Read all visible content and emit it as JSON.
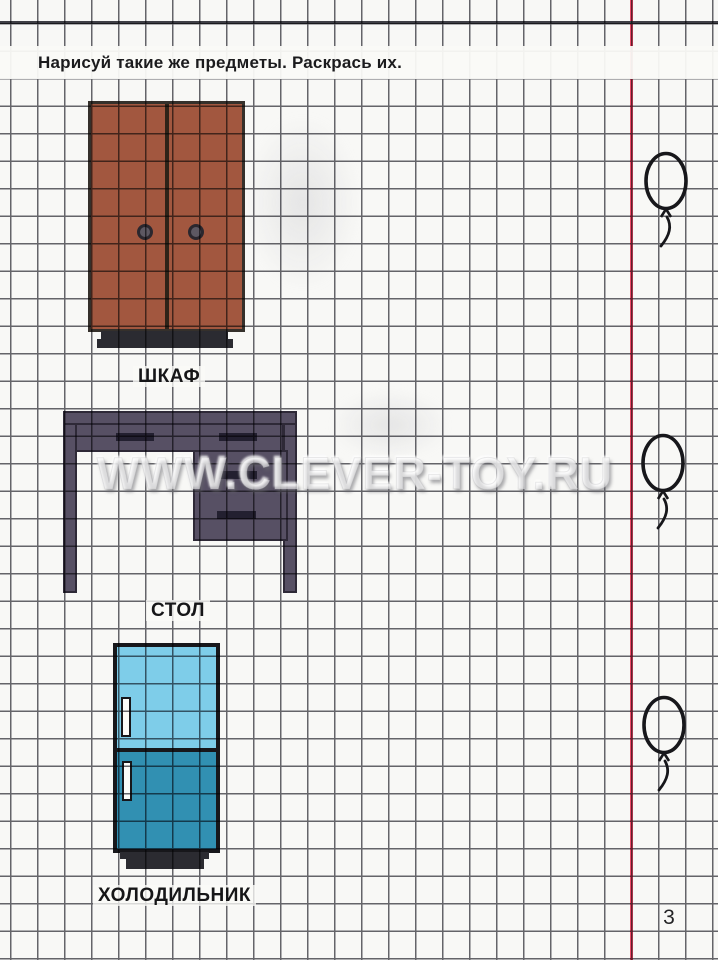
{
  "page": {
    "instruction": "Нарисуй такие же предметы. Раскрась их.",
    "watermark": "WWW.CLEVER-TOY.RU",
    "page_number": "3"
  },
  "items": [
    {
      "name": "wardrobe",
      "label": "ШКАФ"
    },
    {
      "name": "desk",
      "label": "СТОЛ"
    },
    {
      "name": "refrigerator",
      "label": "ХОЛОДИЛЬНИК"
    }
  ],
  "decorations": {
    "balloon_count": 3
  },
  "colors": {
    "paper": "#f8f8f6",
    "grid_line": "#3c3c44",
    "margin_line": "#ee4b68",
    "wardrobe_fill": "#a2573f",
    "desk_fill": "#575064",
    "fridge_top_fill": "#7ecde9",
    "fridge_bottom_fill": "#3190b2",
    "dark_base": "#2b2b31",
    "ink": "#161618"
  }
}
